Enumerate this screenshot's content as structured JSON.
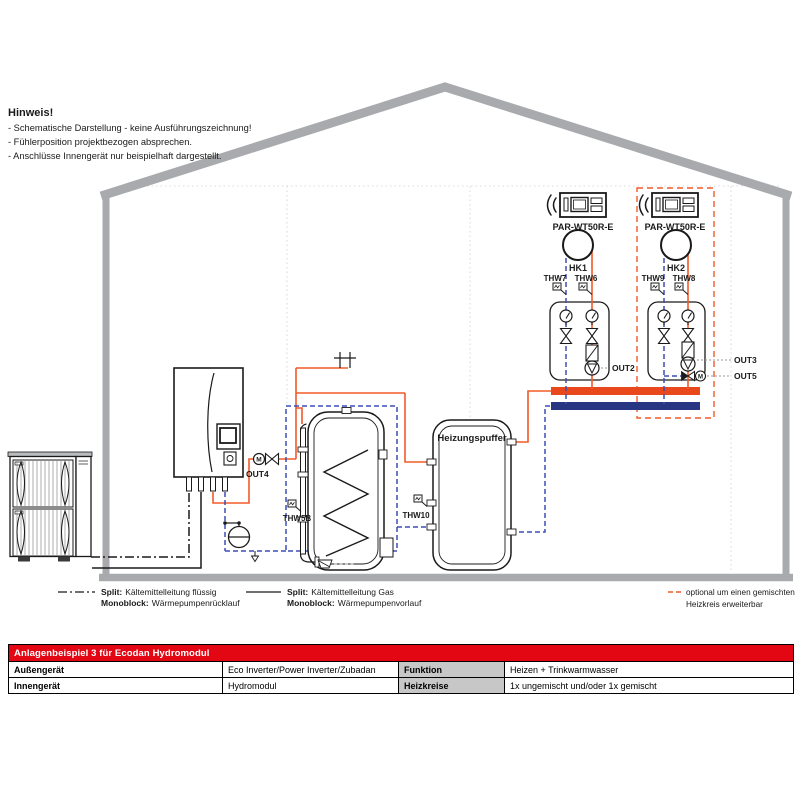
{
  "hinweis": {
    "title": "Hinweis!",
    "items": [
      "- Schematische Darstellung - keine Ausführungszeichnung!",
      "- Fühlerposition projektbezogen absprechen.",
      "- Anschlüsse Innengerät nur beispielhaft dargestellt."
    ]
  },
  "labels": {
    "motor": "M",
    "out2": "OUT2",
    "out3": "OUT3",
    "out4": "OUT4",
    "out5": "OUT5",
    "thw5b": "THW5B",
    "thw10": "THW10",
    "thw7": "THW7",
    "thw6": "THW6",
    "thw9": "THW9",
    "thw8": "THW8",
    "hk1": "HK1",
    "hk2": "HK2",
    "par1": "PAR-WT50R-E",
    "par2": "PAR-WT50R-E",
    "buffer_tank": "Heizungspuffer"
  },
  "legend": {
    "item1": {
      "k1": "Split:",
      "v1": "Kältemittelleitung flüssig",
      "k2": "Monoblock:",
      "v2": "Wärmepumpenrücklauf"
    },
    "item2": {
      "k1": "Split:",
      "v1": "Kältemittelleitung Gas",
      "k2": "Monoblock:",
      "v2": "Wärmepumpenvorlauf"
    },
    "optional": {
      "line1": "optional um einen gemischten",
      "line2": "Heizkreis erweiterbar"
    }
  },
  "table": {
    "title": "Anlagenbeispiel 3 für Ecodan Hydromodul",
    "rows": [
      {
        "label1": "Außengerät",
        "value1": "Eco Inverter/Power Inverter/Zubadan",
        "label2": "Funktion",
        "value2": "Heizen + Trinkwarmwasser"
      },
      {
        "label1": "Innengerät",
        "value1": "Hydromodul",
        "label2": "Heizkreise",
        "value2": "1x ungemischt und/oder 1x gemischt"
      }
    ]
  },
  "colors": {
    "flow_line": "#f15a29",
    "return_line": "#3d4db7",
    "manifold_flow": "#e8481c",
    "manifold_return": "#283583",
    "optional_dashed": "#f15a29",
    "optional_text": "#e63312",
    "table_header": "#e30613",
    "house_gray": "#a8aaad"
  }
}
